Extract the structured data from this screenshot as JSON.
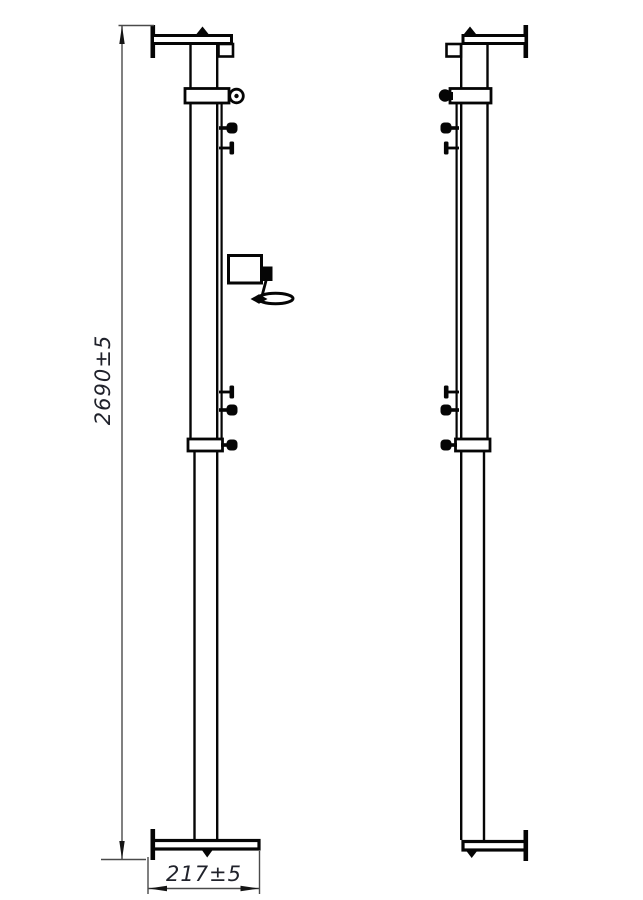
{
  "drawing": {
    "type": "technical-drawing",
    "views": {
      "left_post": {
        "name": "front post with winch",
        "parts": [
          "top-flange",
          "cable-pulley",
          "net-hooks",
          "winch-with-crank-handle",
          "telescopic-collar",
          "base-flange"
        ]
      },
      "right_post": {
        "name": "rear post",
        "parts": [
          "top-flange",
          "cable-eyelet",
          "net-hooks",
          "telescopic-collar",
          "base-flange"
        ]
      }
    }
  },
  "dimensions": {
    "height": {
      "label": "2690±5",
      "value": 2690,
      "tolerance": 5
    },
    "width": {
      "label": "217±5",
      "value": 217,
      "tolerance": 5
    }
  },
  "colors": {
    "line": "#050505",
    "dimension_line": "#4a4a4a",
    "arrow": "#151515",
    "dimension_text": "#20222b",
    "background": "#ffffff"
  }
}
